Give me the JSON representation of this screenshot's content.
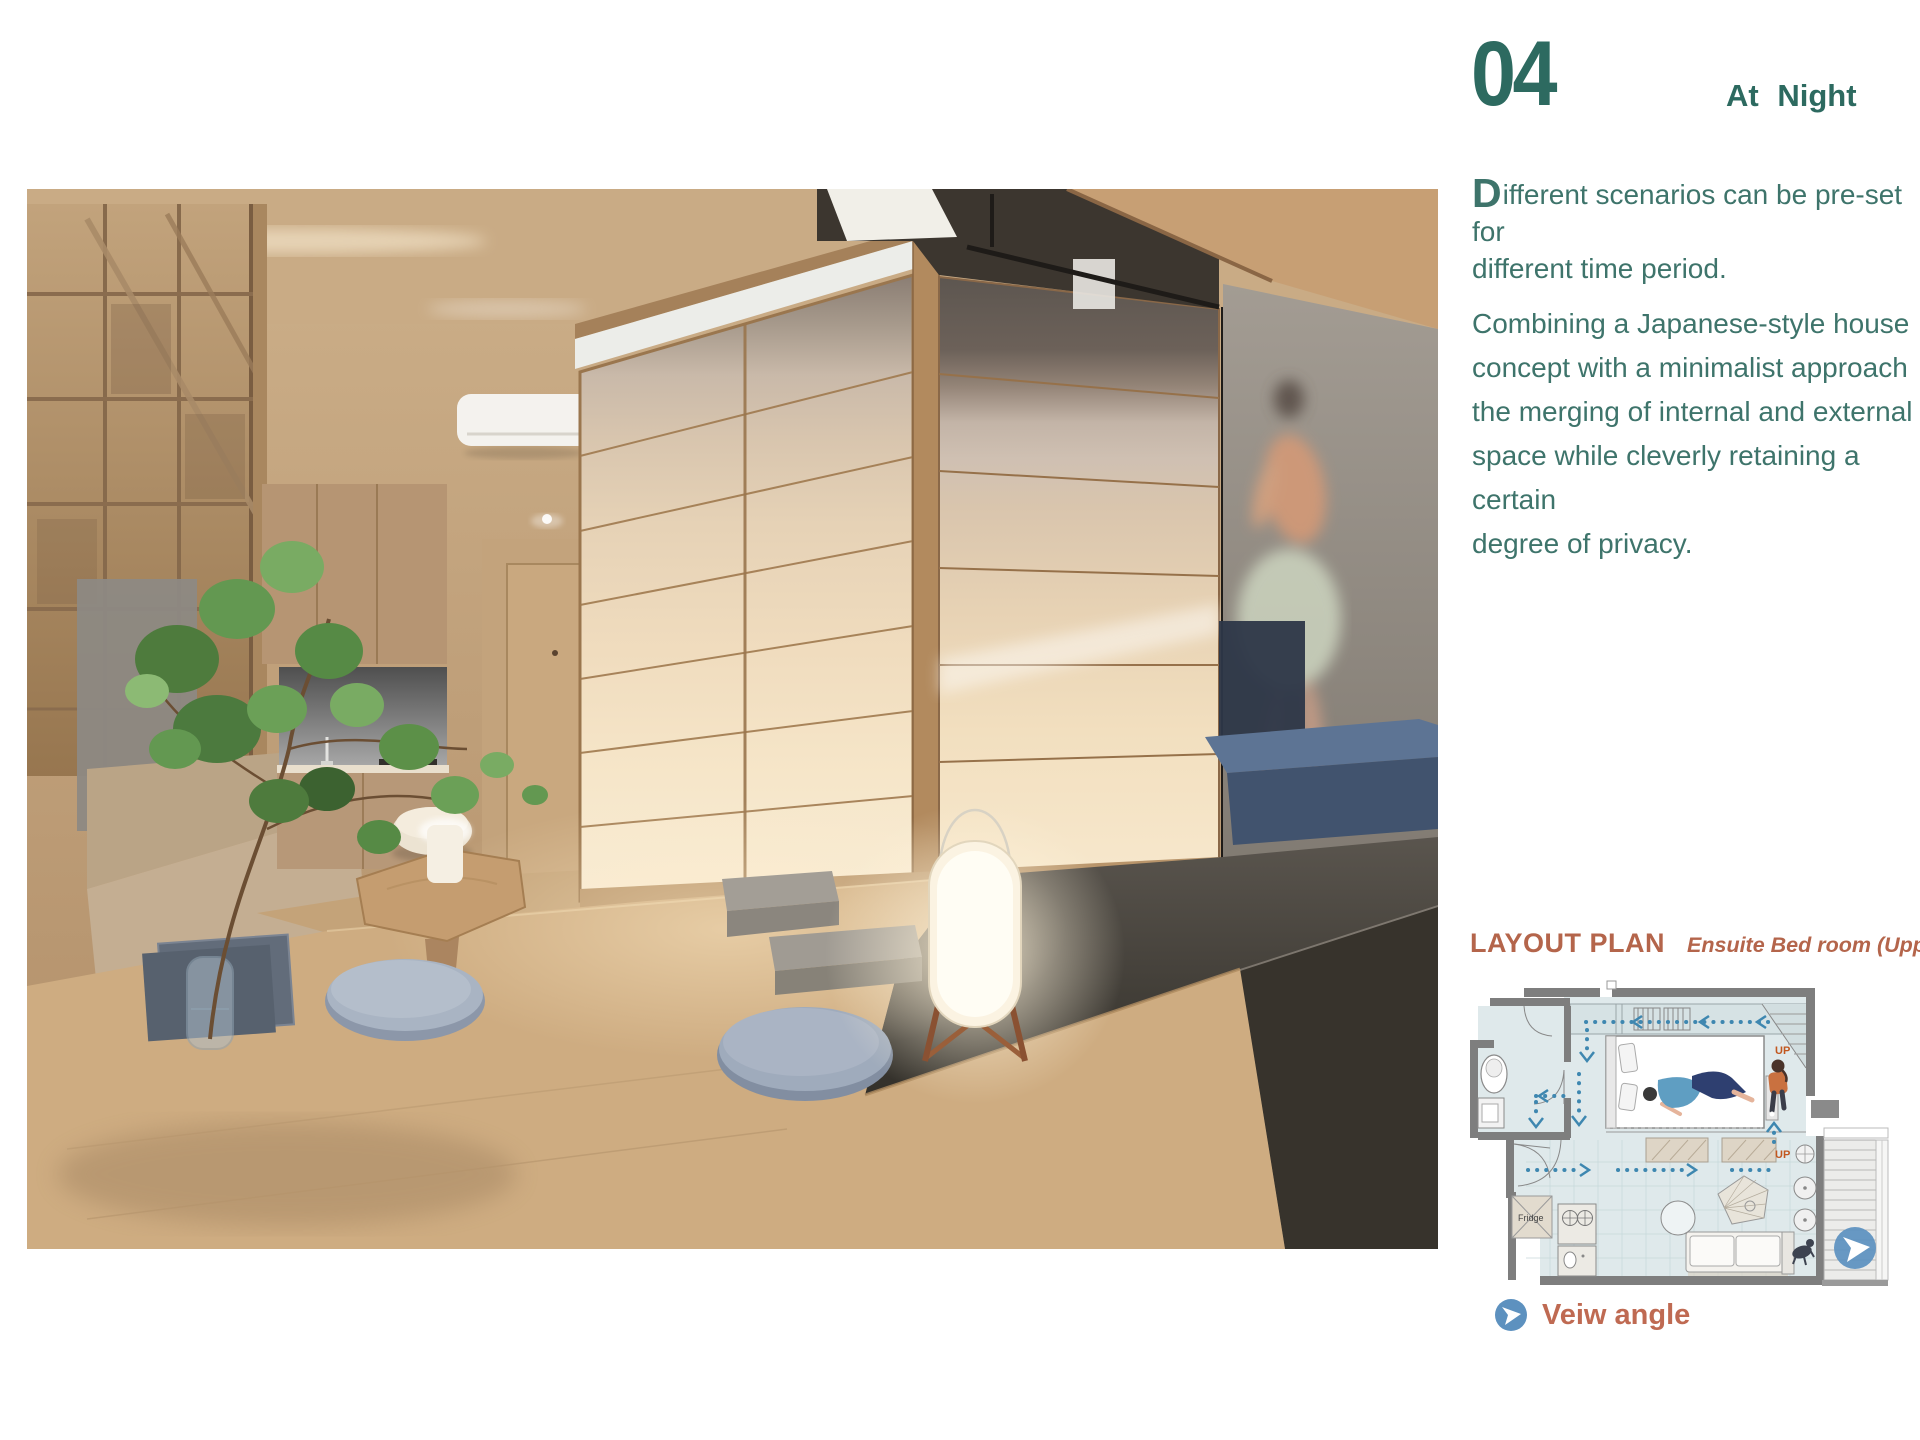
{
  "header": {
    "page_number": "04",
    "section_title": "At Night"
  },
  "description": {
    "dropcap": "D",
    "p1_lines": [
      "ifferent scenarios can be pre-set for",
      "different time period."
    ],
    "p2_lines": [
      "Combining a Japanese-style house",
      "concept with a minimalist approach",
      "the merging of internal and external",
      "space while cleverly retaining a certain",
      "degree of privacy."
    ]
  },
  "layout_plan": {
    "title": "LAYOUT PLAN",
    "subtitle": "Ensuite Bed room (Upper Level)",
    "up_label_1": "UP",
    "up_label_2": "UP",
    "fridge_label": "Fridge",
    "view_angle_label": "Veiw angle"
  },
  "colors": {
    "teal": "#2d6a60",
    "tealText": "#3e746b",
    "terracotta": "#b4654b",
    "terracotta2": "#bf6a52",
    "planFloor": "#dfe9eb",
    "planDots": "#3e87b0",
    "iconBlue": "#5d91bf",
    "upOrange": "#c2571f"
  }
}
